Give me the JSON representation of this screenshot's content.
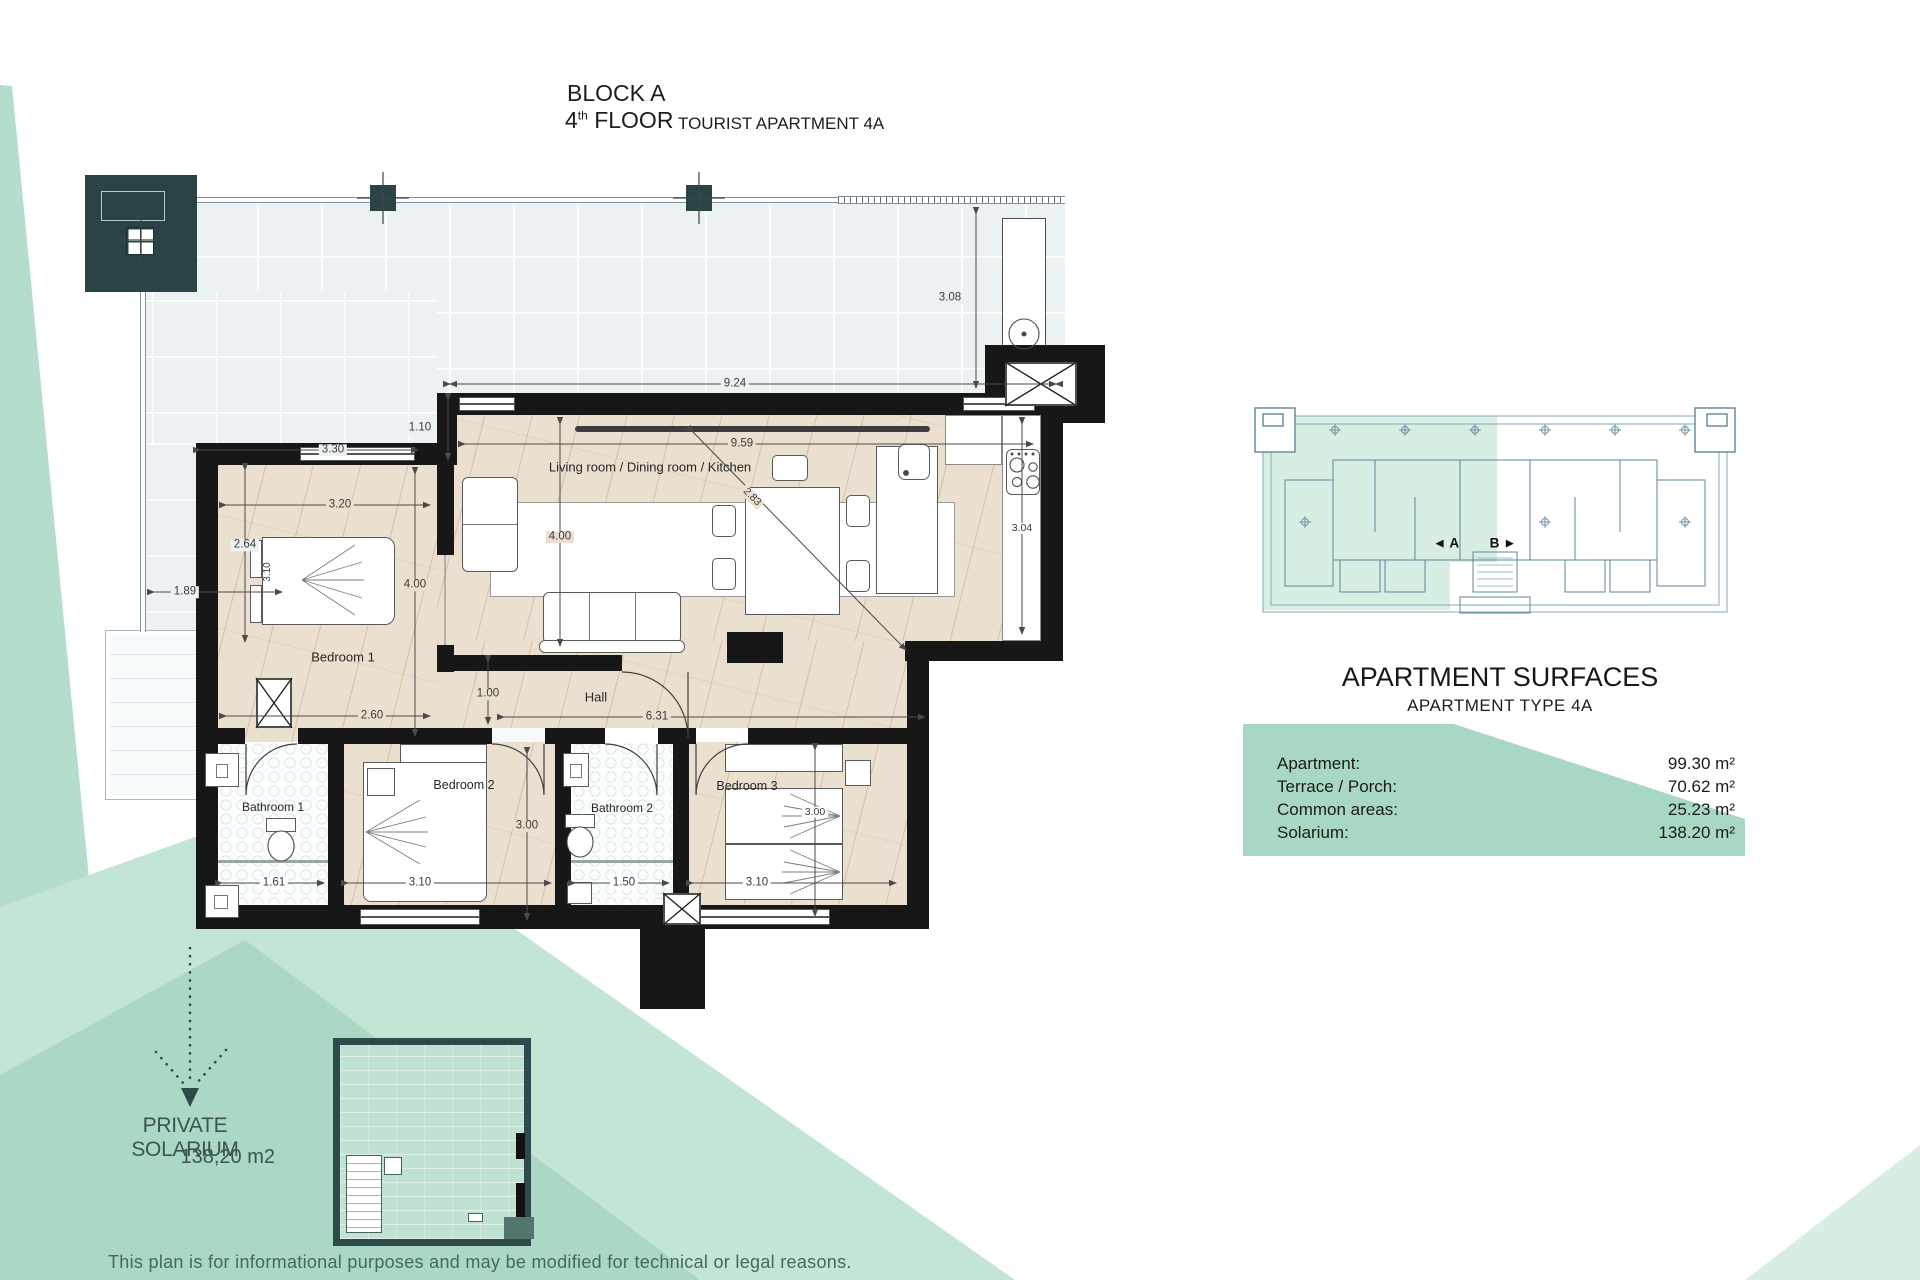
{
  "title": {
    "block_label": "BLOCK A",
    "floor_number": "4",
    "floor_ordinal": "th",
    "floor_word": " FLOOR",
    "apartment_label": "TOURIST APARTMENT 4A"
  },
  "plan": {
    "rooms": {
      "living": "Living room / Dining room / Kitchen",
      "bedroom1": "Bedroom 1",
      "bedroom2": "Bedroom 2",
      "bedroom3": "Bedroom 3",
      "bathroom1": "Bathroom 1",
      "bathroom2": "Bathroom 2",
      "hall": "Hall"
    },
    "dims": {
      "terrace_top": "9.24",
      "terrace_right": "3.08",
      "step": "1.10",
      "bed1_zone": "3.30",
      "bed1_width": "3.20",
      "terrace_left_h": "2.64",
      "terrace_left_w": "1.89",
      "bed1_bed": "3.10",
      "bed1_depth": "4.00",
      "living_width": "9.59",
      "living_depth": "4.00",
      "kitchen_len": "3.04",
      "living_diag": "2.83",
      "bed1_bottom": "2.60",
      "hall_depth": "1.00",
      "hall_width": "6.31",
      "bed2_depth": "3.00",
      "bath1_width": "1.61",
      "bed2_width": "3.10",
      "bath2_width": "1.50",
      "bed3_width": "3.10",
      "bed3_depth": "3.00"
    }
  },
  "overview": {
    "apartment_a": "◄ A",
    "apartment_b": "B ►"
  },
  "surfaces": {
    "title": "APARTMENT SURFACES",
    "subtitle": "APARTMENT TYPE 4A",
    "rows": [
      {
        "label": "Apartment:",
        "value": "99.30 m²"
      },
      {
        "label": "Terrace / Porch:",
        "value": "70.62 m²"
      },
      {
        "label": "Common areas:",
        "value": "25.23 m²"
      },
      {
        "label": "Solarium:",
        "value": "138.20 m²"
      }
    ]
  },
  "solarium": {
    "title": "PRIVATE SOLARIUM",
    "area": "138,20 m2"
  },
  "footer": {
    "disclaimer": "This plan is for informational purposes and may be modified for technical or legal reasons."
  },
  "colors": {
    "green_light": "#c3e5d4",
    "green_mid": "#b4ddcb",
    "green_dark": "#abd8c4",
    "table_green": "#a8d7c3",
    "teal_dark": "#2e4a4a",
    "wall_black": "#171717",
    "wood_floor": "#ebe0d0",
    "terrace_blue": "#ecf2f3"
  }
}
